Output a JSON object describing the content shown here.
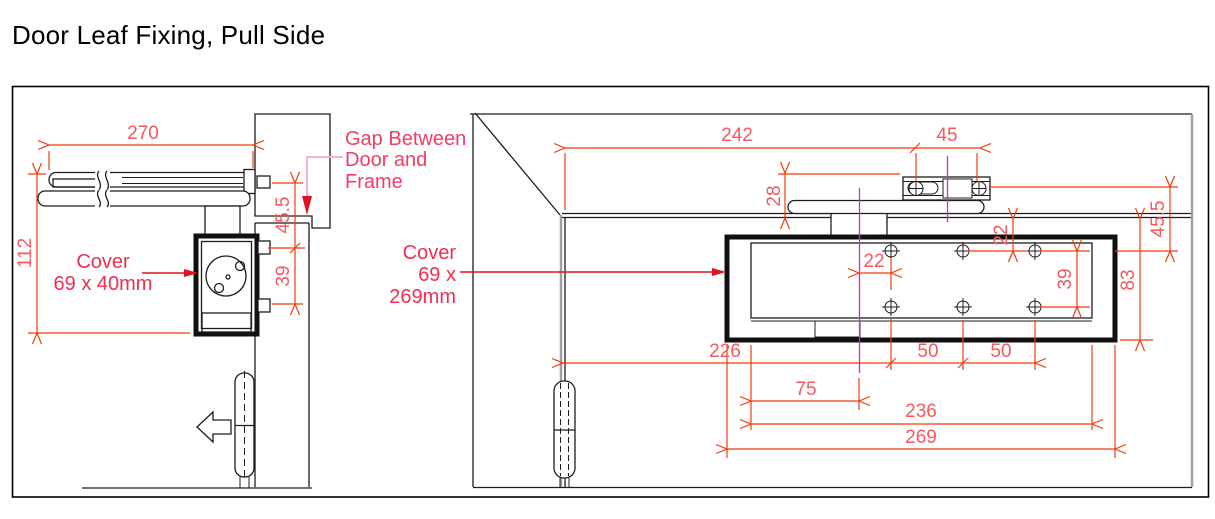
{
  "title": "Door Leaf Fixing, Pull Side",
  "colors": {
    "dim_line": "#f23b0c",
    "dim_text": "#f5595f",
    "label_red": "#ee2f4e",
    "gap_pink": "#f23d63",
    "leader_pink": "#f8b4c6",
    "leader_red": "#e0121f",
    "magenta": "#f012f0",
    "line_black": "#1c1c1c",
    "gray": "#a0a0a0"
  },
  "left_view": {
    "dim_270": "270",
    "dim_112": "112",
    "dim_45_5": "45.5",
    "dim_39": "39",
    "cover_label": [
      "Cover",
      "69 x 40mm"
    ],
    "gap_label": [
      "Gap Between",
      "Door and",
      "Frame"
    ]
  },
  "right_view": {
    "dim_242": "242",
    "dim_45": "45",
    "dim_28": "28",
    "dim_22_top": "22",
    "dim_45_5": "45.5",
    "dim_83": "83",
    "dim_22_pivot": "22",
    "dim_39": "39",
    "dim_226": "226",
    "dim_50_a": "50",
    "dim_50_b": "50",
    "dim_75": "75",
    "dim_236": "236",
    "dim_269": "269",
    "cover_label": [
      "Cover",
      "69 x",
      "269mm"
    ]
  }
}
